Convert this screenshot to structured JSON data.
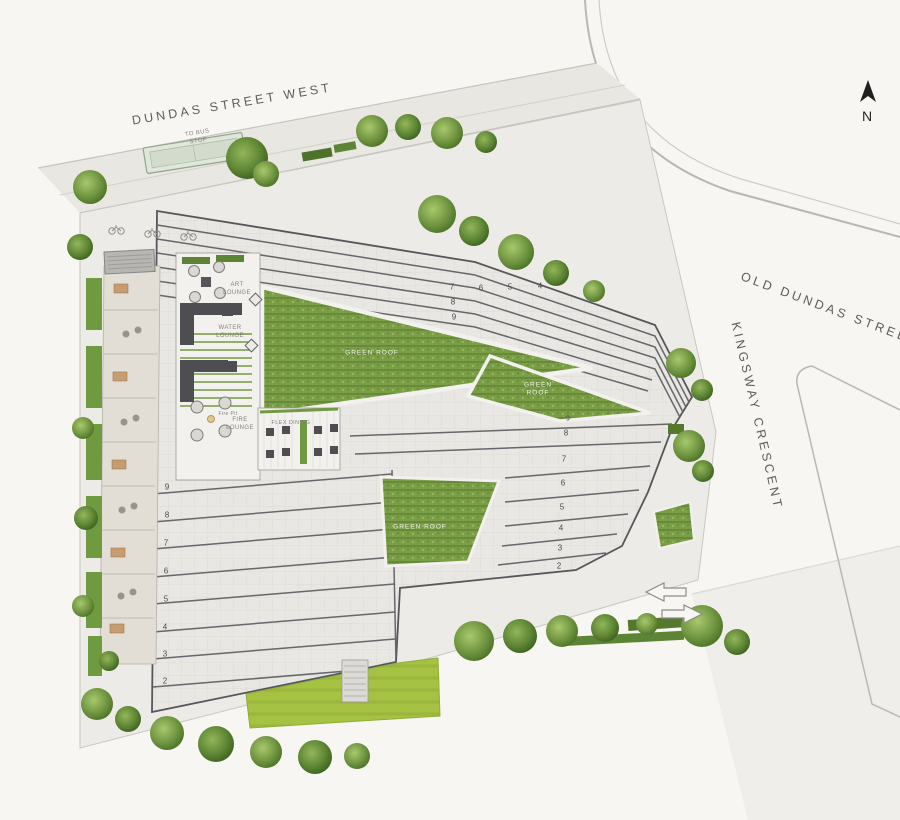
{
  "page": {
    "background": "#f7f6f2"
  },
  "streets": {
    "dundas_west": "DUNDAS STREET WEST",
    "old_dundas": "OLD DUNDAS STREET",
    "kingsway": "KINGSWAY CRESCENT"
  },
  "compass": {
    "north_label": "N"
  },
  "site_labels": {
    "to_bus_stop": "TO BUS STOP",
    "art_lounge": "ART LOUNGE",
    "water_lounge": "WATER LOUNGE",
    "fire_pit": "Fire Pit",
    "fire_lounge": "FIRE LOUNGE",
    "flex_dining": "FLEX DINING",
    "green_roof_upper": "GREEN ROOF",
    "green_roof_east": "GREEN ROOF",
    "green_roof_lower": "GREEN ROOF"
  },
  "floor_levels": {
    "west_wing": [
      "9",
      "8",
      "7",
      "6",
      "5",
      "4",
      "3",
      "2"
    ],
    "east_wing": [
      "9",
      "8",
      "7",
      "6",
      "5",
      "4",
      "3",
      "2"
    ],
    "north_wing_row": [
      "7",
      "6",
      "5",
      "4"
    ],
    "north_wing_column": [
      "8",
      "9"
    ]
  },
  "colors": {
    "green_roof": "#7a9e45",
    "lawn": "#a6c243",
    "paving": "#e8e7e3",
    "building_outline": "#56565b",
    "tree_dark": "#4d7328",
    "label_gray": "#6b6b67"
  }
}
